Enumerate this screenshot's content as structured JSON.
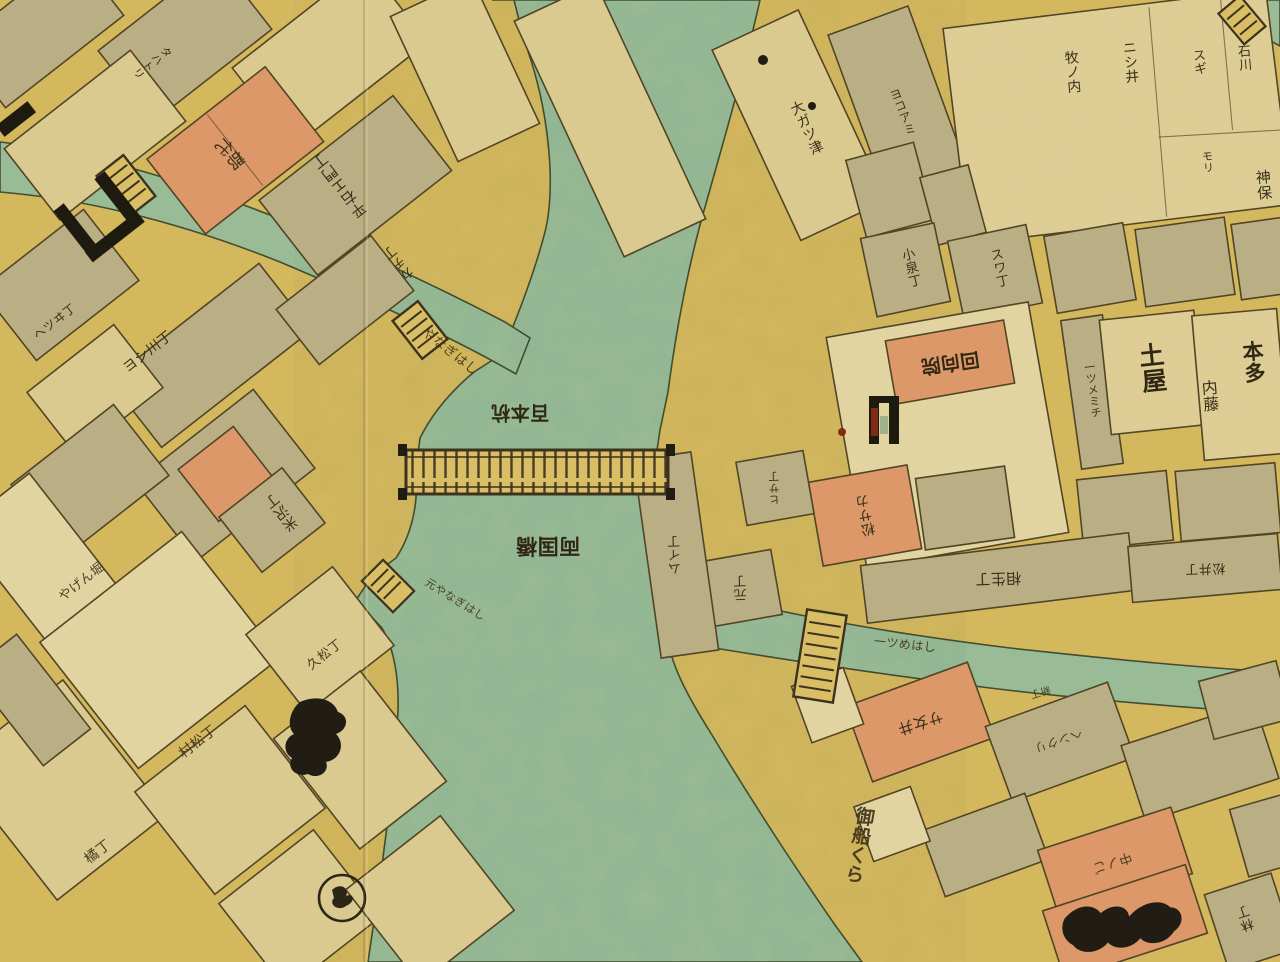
{
  "map": {
    "kind": "edo-period woodblock city map (kiriezu)",
    "region_depicted": "両国橋・隅田川界隈",
    "palette": {
      "street_yellow": "#e3cd7d",
      "block_cream": "#e9e1c2",
      "block_gray": "#c7c3b1",
      "block_pink": "#eba98c",
      "block_white": "#f2ecd8",
      "water_blue": "#a3d0c9",
      "ink": "#3c3522",
      "ink_black": "#1f1c14",
      "seal_red": "#a23b24"
    },
    "water_features": [
      {
        "name": "sumida-river"
      },
      {
        "name": "kanda-river-canal"
      },
      {
        "name": "tatekawa-canal"
      },
      {
        "name": "corner-moat"
      }
    ],
    "bridges": [
      {
        "name": "ryogoku-bashi"
      },
      {
        "name": "yanagi-bashi"
      },
      {
        "name": "asakusa-bashi"
      },
      {
        "name": "moto-yanagi-bashi"
      },
      {
        "name": "hitotsume-bashi"
      },
      {
        "name": "corner-bashi"
      }
    ],
    "labels": [
      {
        "text": "平右エ門丁"
      },
      {
        "text": "郡代"
      },
      {
        "text": "タハトリ"
      },
      {
        "text": "カヂ丁"
      },
      {
        "text": "やなぎはし"
      },
      {
        "text": "ヨシ川丁"
      },
      {
        "text": "ヘツヰ丁"
      },
      {
        "text": "米沢丁"
      },
      {
        "text": "やげん堀"
      },
      {
        "text": "元やなぎはし"
      },
      {
        "text": "両国橋"
      },
      {
        "text": "百本杭"
      },
      {
        "text": "村松丁"
      },
      {
        "text": "久松丁"
      },
      {
        "text": "橘丁"
      },
      {
        "text": "大ガツ津"
      },
      {
        "text": "ヨコアミ"
      },
      {
        "text": "小泉丁"
      },
      {
        "text": "スワ丁"
      },
      {
        "text": "回向院"
      },
      {
        "text": "一ツメミチ"
      },
      {
        "text": "土屋"
      },
      {
        "text": "本多"
      },
      {
        "text": "内藤"
      },
      {
        "text": "牧ノ内"
      },
      {
        "text": "ニシ井"
      },
      {
        "text": "スギ"
      },
      {
        "text": "石川"
      },
      {
        "text": "モリ"
      },
      {
        "text": "神保"
      },
      {
        "text": "松サカ"
      },
      {
        "text": "元丁"
      },
      {
        "text": "ムイ丁"
      },
      {
        "text": "ヒサ丁"
      },
      {
        "text": "相生丁"
      },
      {
        "text": "松井丁"
      },
      {
        "text": "一ツめはし"
      },
      {
        "text": "サ女井"
      },
      {
        "text": "ヘンクリ"
      },
      {
        "text": "新丁"
      },
      {
        "text": "中ノご"
      },
      {
        "text": "林丁"
      },
      {
        "text": "御船くら"
      }
    ]
  }
}
